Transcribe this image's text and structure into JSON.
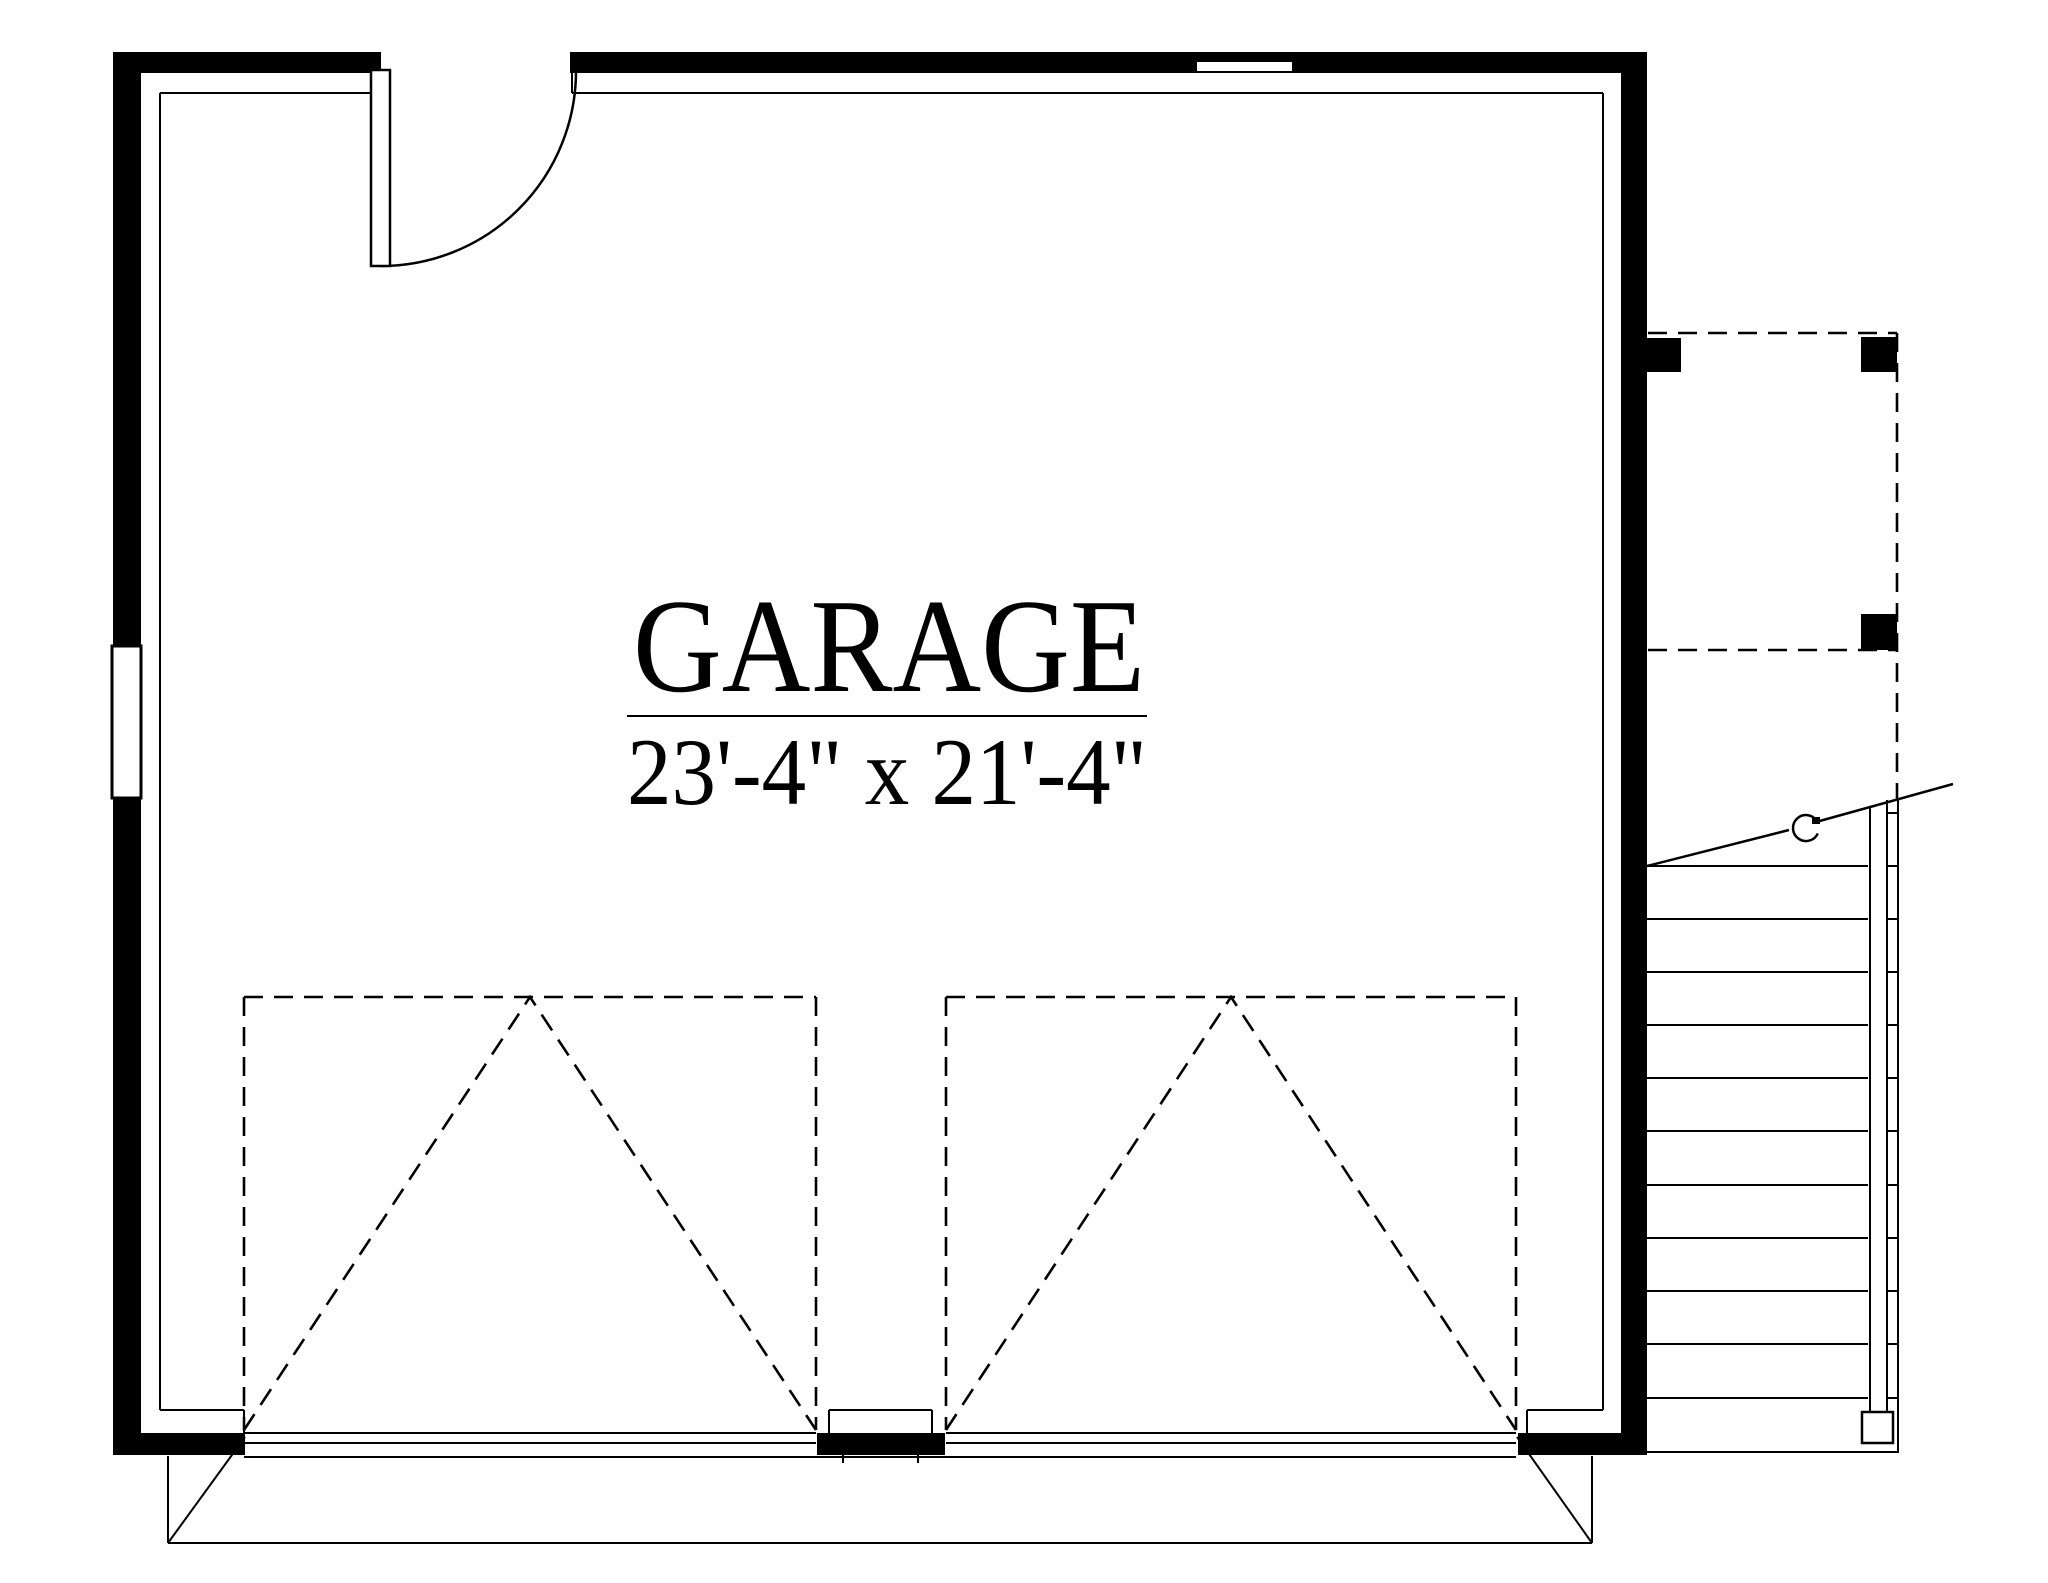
{
  "floor_plan": {
    "room_label": "GARAGE",
    "room_dimensions": "23'-4\" x 21'-4\"",
    "colors": {
      "line": "#000000",
      "wall_fill": "#000000",
      "background": "#ffffff"
    }
  }
}
